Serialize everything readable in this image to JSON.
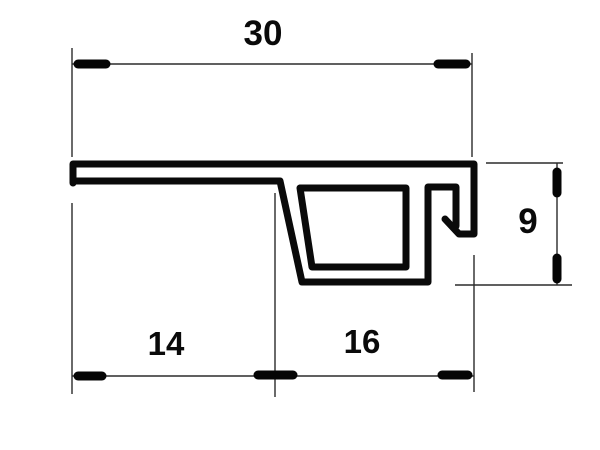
{
  "drawing": {
    "description": "technical cross-section drawing of an extruded trim profile with dimension lines",
    "background_color": "#ffffff",
    "profile_stroke_color": "#0a0a0a",
    "dimension_line_color": "#2b2b2b",
    "dim_labels": {
      "top_width": "30",
      "bottom_left_width": "14",
      "bottom_right_width": "16",
      "right_height": "9"
    }
  }
}
